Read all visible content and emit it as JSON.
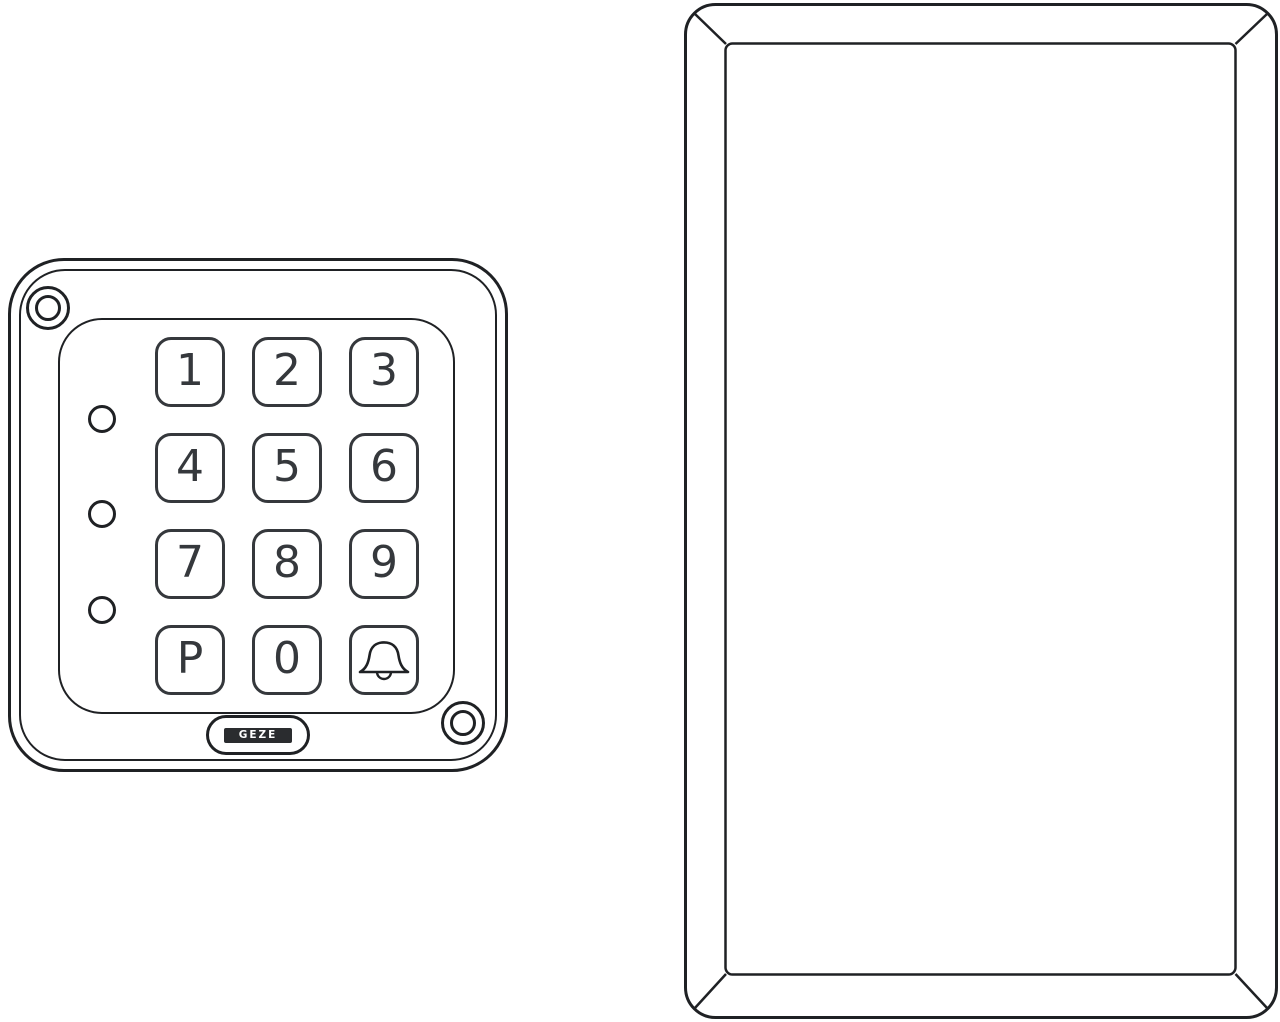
{
  "illustration": {
    "type": "technical line drawing",
    "left_object": "code keypad front view",
    "right_object": "blank beveled cover plate front view"
  },
  "keypad": {
    "keys": [
      "1",
      "2",
      "3",
      "4",
      "5",
      "6",
      "7",
      "8",
      "9",
      "P",
      "0"
    ],
    "bell_key_icon": "bell-icon",
    "logo": "GEZE",
    "led_count": 3,
    "screw_count": 2
  },
  "cover_plate": {
    "description": "empty rectangular plate with beveled frame and rounded outer corners"
  },
  "colors": {
    "line": "#1f2124",
    "digit": "#35383c",
    "logo_bg": "#2a2c2f",
    "background": "#ffffff"
  }
}
